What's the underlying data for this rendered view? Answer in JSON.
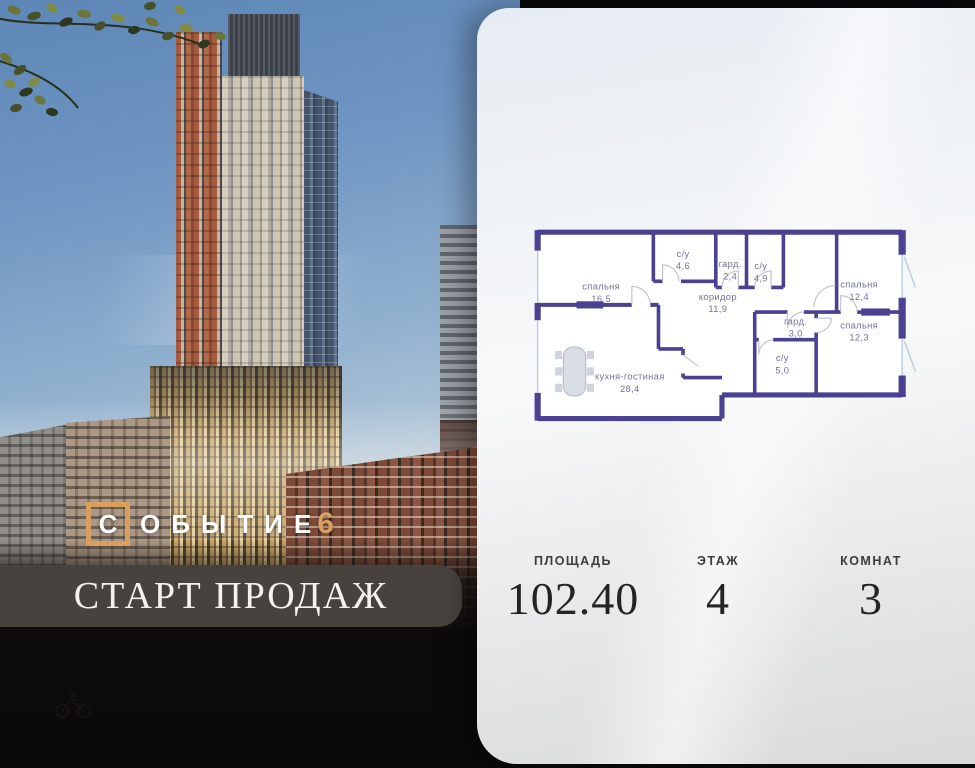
{
  "logo": {
    "first_letter": "С",
    "rest": "ОБЫТИЕ",
    "number": "6",
    "accent_color": "#d7a05f"
  },
  "banner": {
    "text": "СТАРТ ПРОДАЖ",
    "bg_color": "#48423f"
  },
  "stats": [
    {
      "label": "ПЛОЩАДЬ",
      "value": "102.40"
    },
    {
      "label": "ЭТАЖ",
      "value": "4"
    },
    {
      "label": "КОМНАТ",
      "value": "3"
    }
  ],
  "floorplan": {
    "wall_color": "#4a4190",
    "label_color": "#73739b",
    "window_color": "#b9cde0",
    "rooms": [
      {
        "name": "спальня",
        "area": "16,5",
        "x": 70,
        "y": 64
      },
      {
        "name": "с/у",
        "area": "4,6",
        "x": 150,
        "y": 32
      },
      {
        "name": "гард.",
        "area": "2,4",
        "x": 196,
        "y": 42
      },
      {
        "name": "с/у",
        "area": "4,9",
        "x": 226,
        "y": 44
      },
      {
        "name": "коридор",
        "area": "11,9",
        "x": 184,
        "y": 74
      },
      {
        "name": "спальня",
        "area": "12,4",
        "x": 322,
        "y": 62
      },
      {
        "name": "гард.",
        "area": "3,0",
        "x": 260,
        "y": 98
      },
      {
        "name": "спальня",
        "area": "12,3",
        "x": 322,
        "y": 102
      },
      {
        "name": "с/у",
        "area": "5,0",
        "x": 247,
        "y": 134
      },
      {
        "name": "кухня-гостиная",
        "area": "28,4",
        "x": 98,
        "y": 152
      }
    ]
  }
}
